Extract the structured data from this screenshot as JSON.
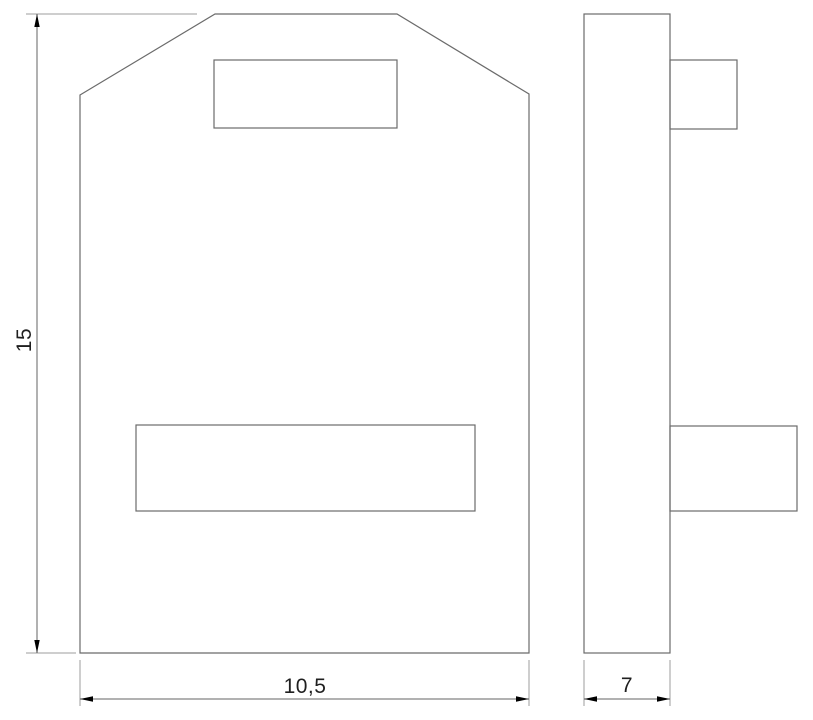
{
  "drawing": {
    "type": "technical-dimension-drawing",
    "views": {
      "front": {
        "name": "front-view"
      },
      "side": {
        "name": "side-view"
      }
    },
    "dimensions": {
      "height": {
        "value": "15"
      },
      "width": {
        "value": "10,5"
      },
      "depth": {
        "value": "7"
      }
    },
    "colors": {
      "background": "#ffffff",
      "outline": "#6b6b6b",
      "dimension_line": "#636363",
      "extension_line": "#9e9e9e",
      "arrow": "#000000",
      "text": "#1f1f1f"
    }
  }
}
